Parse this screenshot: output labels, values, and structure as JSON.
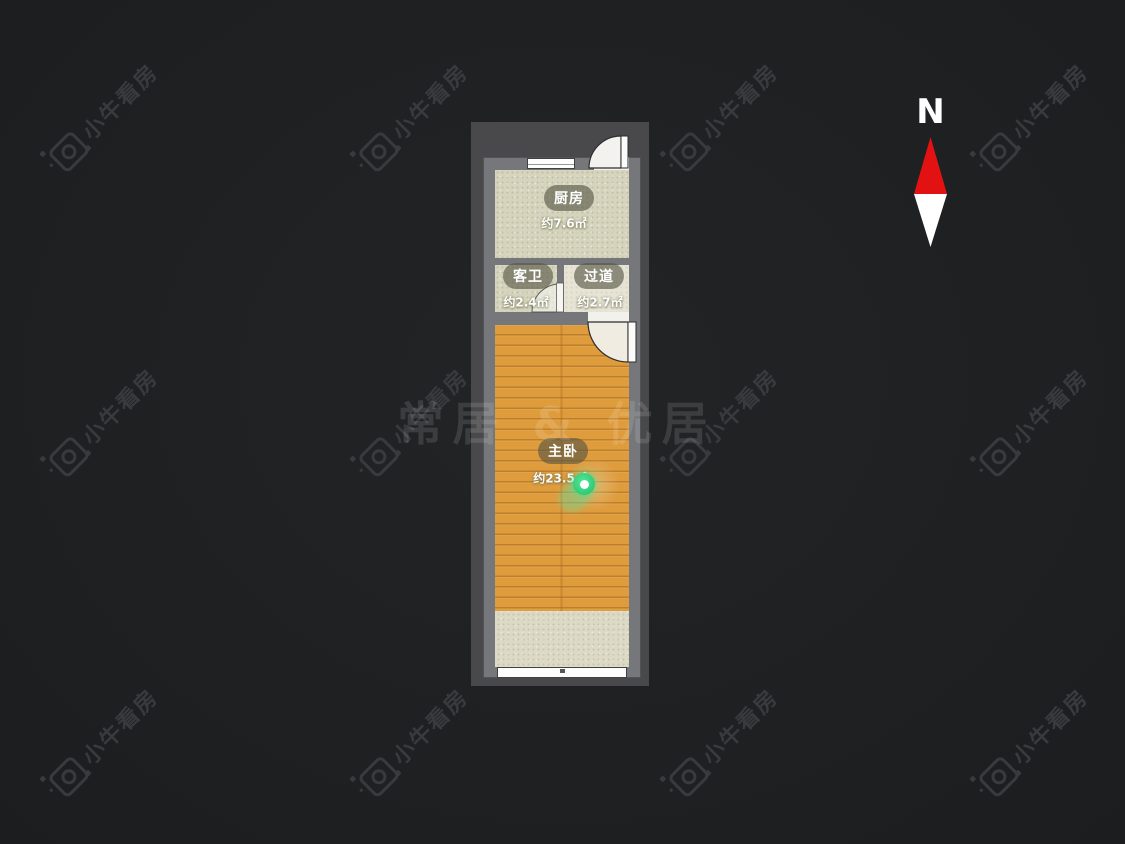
{
  "brand_watermark": {
    "text": "小牛看房",
    "icon": "camera-logo-icon"
  },
  "center_watermark": {
    "text": "常居 & 优居"
  },
  "compass": {
    "north_label": "N",
    "arrow_top_color": "#e31212",
    "arrow_bottom_color": "#ffffff"
  },
  "floorplan": {
    "rooms": [
      {
        "name": "厨房",
        "area": "约7.6㎡"
      },
      {
        "name": "客卫",
        "area": "约2.4㎡"
      },
      {
        "name": "过道",
        "area": "约2.7㎡"
      },
      {
        "name": "主卧",
        "area": "约23.5㎡"
      }
    ],
    "marker": {
      "name": "location-pin",
      "color": "#2fd573"
    },
    "colors": {
      "background": "#1f2123",
      "frame": "#49494b",
      "wall": "#76777a",
      "tile_floor": "#d6d4bd",
      "hall_floor": "#e7e4d6",
      "balcony_floor": "#dcd9c5",
      "wood_floor": "#df9c3d"
    }
  }
}
